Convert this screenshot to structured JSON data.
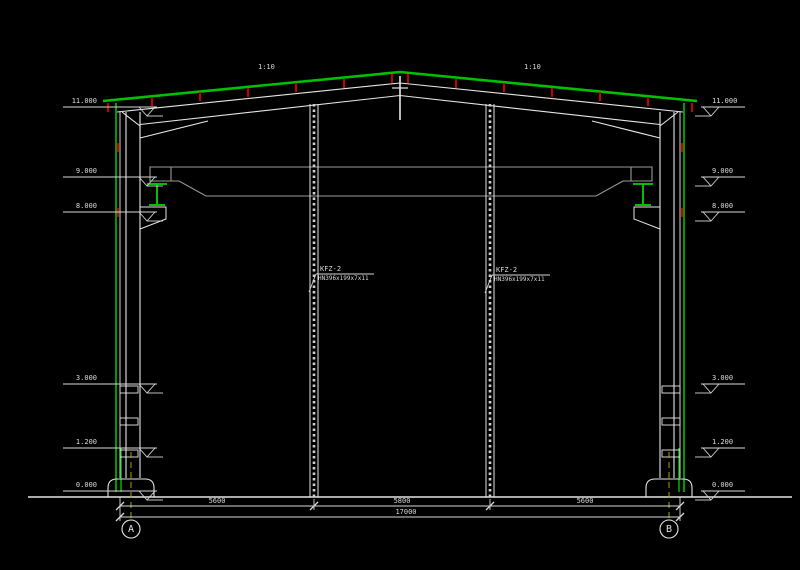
{
  "drawing": {
    "title": "gable-end steel frame section",
    "slope_labels": {
      "left": "1:10",
      "right": "1:10"
    },
    "elevations_left": [
      "11.000",
      "9.000",
      "8.000",
      "3.000",
      "1.200",
      "0.000"
    ],
    "elevations_right": [
      "11.000",
      "9.000",
      "8.000",
      "3.000",
      "1.200",
      "0.000"
    ],
    "wind_columns": [
      {
        "name": "KFZ-2",
        "section": "HN396x199x7x11"
      },
      {
        "name": "KFZ-2",
        "section": "HN396x199x7x11"
      }
    ],
    "dimensions": {
      "segments": [
        "5600",
        "5800",
        "5600"
      ],
      "total": "17000"
    },
    "axes": {
      "left": "A",
      "right": "B"
    },
    "colors": {
      "background": "#000000",
      "line_white": "#e6e6e6",
      "sheeting_green": "#00c000",
      "purlin_red": "#c40000",
      "axis_yellow": "#a6a600",
      "crane_gray": "#9a9a9a"
    }
  }
}
